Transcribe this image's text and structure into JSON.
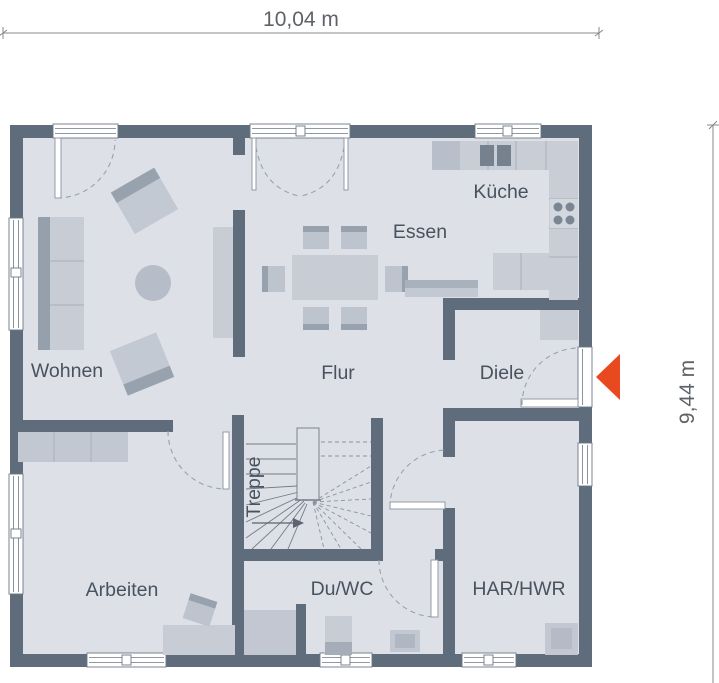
{
  "dimensions": {
    "width_label": "10,04 m",
    "height_label": "9,44 m"
  },
  "rooms": {
    "wohnen": {
      "label": "Wohnen"
    },
    "essen": {
      "label": "Essen"
    },
    "kueche": {
      "label": "Küche"
    },
    "flur": {
      "label": "Flur"
    },
    "diele": {
      "label": "Diele"
    },
    "treppe": {
      "label": "Treppe"
    },
    "arbeiten": {
      "label": "Arbeiten"
    },
    "duwc": {
      "label": "Du/WC"
    },
    "harhwr": {
      "label": "HAR/HWR"
    }
  },
  "colors": {
    "wall": "#5e6c7b",
    "floor": "#dde1e7",
    "entrance_arrow": "#e8491f"
  }
}
